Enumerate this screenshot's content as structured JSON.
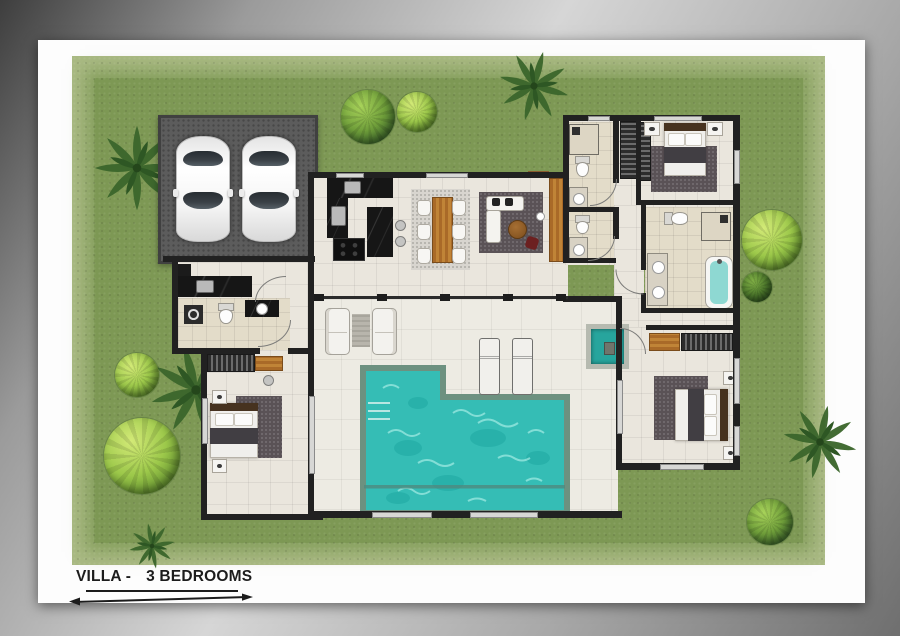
{
  "caption": {
    "part1": "VILLA -",
    "part2": "3 BEDROOMS"
  },
  "colors": {
    "page": "#fdfdfd",
    "wall": "#212121",
    "floor": "#eae6dd",
    "terrace": "#edebe3",
    "bathfloor": "#e3dcc9",
    "garage": "#5c5c5c",
    "lawn": "#7d9854",
    "lawn_edge": "#aaba84",
    "pool_water": "#35bdb5",
    "pool_edge": "#6d9180",
    "wood": "#b5742f",
    "marble": "#161616",
    "rug_dark": "#5a5256",
    "rug_light": "#d8d5cf",
    "tub_water": "#8ed8d2",
    "tree_dark": "#3c672c",
    "tree_mid": "#6f9e3a",
    "tree_light": "#a8d35a",
    "car_glass": "#3a4046",
    "text": "#1c1c1c"
  }
}
